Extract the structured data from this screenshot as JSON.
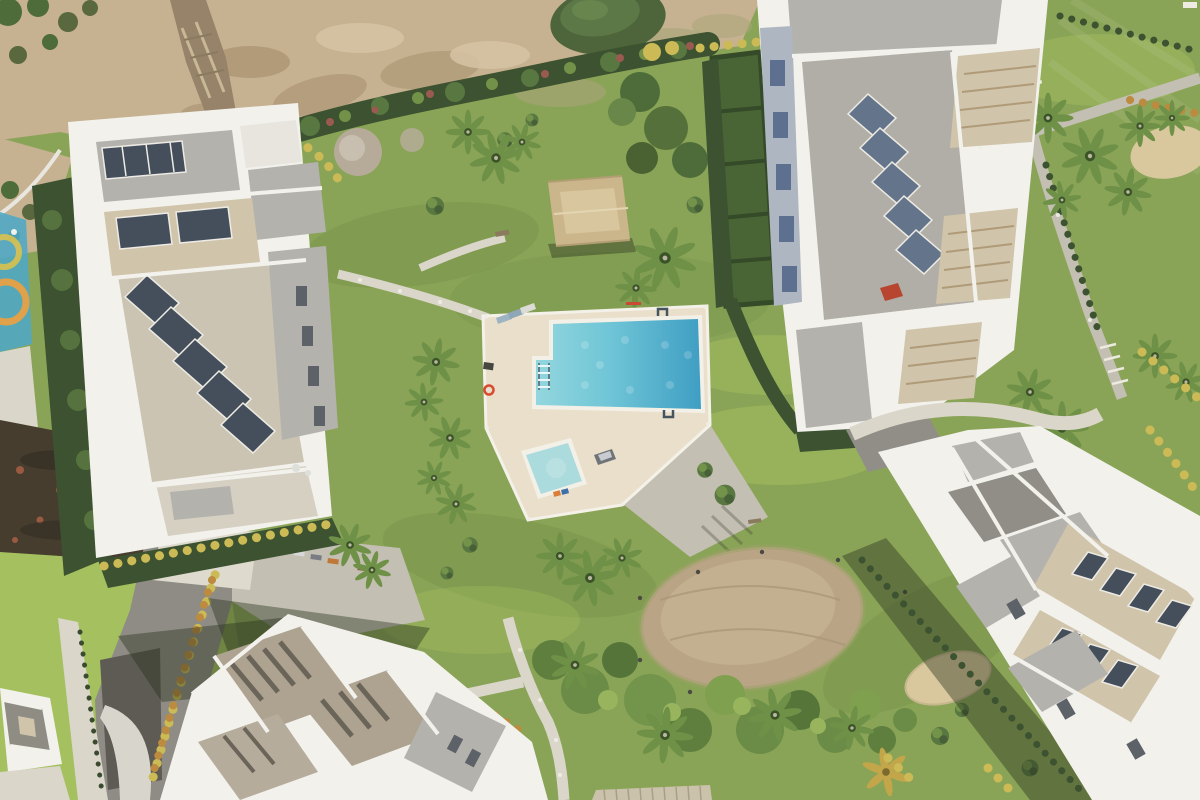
{
  "meta": {
    "title": "Aerial drone view of a modern white apartment complex with communal swimming pool, lawns, palm trees and garden paths",
    "view": "top-down aerial photograph",
    "time_of_day": "sunny daytime, shadows cast toward upper-left"
  },
  "palette": {
    "lawnBase": "#8AA457",
    "lawnLight": "#A4C05F",
    "lawnDark": "#6D8A45",
    "lawnShade": "#4F6A38",
    "dirtField": "#C6B191",
    "dirtDark": "#A8916F",
    "dirtLight": "#D7C6A6",
    "trench": "#96836A",
    "soilDark": "#463D2F",
    "hedgeDark": "#3C5230",
    "hedgeMid": "#597741",
    "hedgeLight": "#7C9C4E",
    "hedgeYellow": "#CBBA55",
    "hedgeOrange": "#BC8B3F",
    "treeGreen": "#4E6C39",
    "palmFrond": "#6E9147",
    "palmCore": "#3C5328",
    "palmGold": "#C2A649",
    "pathGray": "#C3BFB2",
    "pathLight": "#DAD6CA",
    "asphalt": "#5D5B54",
    "deckCream": "#EADFCB",
    "poolRim": "#F3F0E7",
    "poolPale": "#ACDBDE",
    "poolAqua": "#6FC5D6",
    "poolDeep": "#3F9EC3",
    "poolShallow": "#93D6DE",
    "bldWhite": "#F2F1EC",
    "roofGray": "#B4B2AC",
    "roofDark": "#908E87",
    "roofBrown": "#AEA391",
    "bldBeige": "#D0C4AB",
    "solarDark": "#454F5C",
    "solarBlue": "#64748A",
    "slotDark": "#5C6268",
    "shadow": "rgba(40,50,32,0.42)",
    "sand": "#D9C89E",
    "playBlue": "#4FA9C6",
    "playOrange": "#DFA14A",
    "carRed": "#B8452F"
  },
  "scene": {
    "landmarks": [
      {
        "name": "apartment-building-top-left",
        "desc": "White multi-storey block, rooftop terraces, diagonal rows of solar panels"
      },
      {
        "name": "apartment-building-top-right",
        "desc": "White block with large grey roof, solar panels and beige pergolas"
      },
      {
        "name": "apartment-building-bottom-right",
        "desc": "Angled white block with beige roof bands of solar panels"
      },
      {
        "name": "apartment-building-bottom-left",
        "desc": "White block with brown-grey roofs and skylight strips, long shadow"
      },
      {
        "name": "corner-house-bottom-left",
        "desc": "Small white house with grey roof at bottom-left corner"
      },
      {
        "name": "main-swimming-pool",
        "desc": "L-shaped turquoise pool with white coping, ladder and handrails"
      },
      {
        "name": "children-pool",
        "desc": "Small pale-aqua square pool on the same deck"
      },
      {
        "name": "pool-deck",
        "desc": "Cream travertine sun deck with loungers"
      },
      {
        "name": "pool-house",
        "desc": "Small tan hip-roofed pavilion north of the pool"
      },
      {
        "name": "bare-dirt-field",
        "desc": "Unlandscaped earth strip along the top with a construction trench"
      },
      {
        "name": "round-shrub-mound",
        "desc": "Dark green clipped mound at top centre"
      },
      {
        "name": "worn-grass-oval",
        "desc": "Large dry brown oval patch in the lawn, lower centre"
      },
      {
        "name": "tropical-planting-band",
        "desc": "Dense band of palms and shrubs across the bottom"
      },
      {
        "name": "flowering-hedge-band",
        "desc": "Long hedge with pink blooms separating dirt field from gardens"
      },
      {
        "name": "playground",
        "desc": "Small blue and orange playground at the left edge"
      },
      {
        "name": "parking-area",
        "desc": "Grey parking/driveway with a few cars, left of bottom building"
      },
      {
        "name": "garden-paths",
        "desc": "Light grey concrete paths with small bollard lights"
      },
      {
        "name": "boardwalk",
        "desc": "Timber boardwalk at the bottom edge"
      },
      {
        "name": "sand-patches",
        "desc": "Sandy play patches right side and top right"
      },
      {
        "name": "sun-loungers",
        "desc": "Loungers at top-left corner of the pool deck"
      },
      {
        "name": "lifebuoy",
        "desc": "Red-orange life ring on deck edge"
      },
      {
        "name": "golf-cart",
        "desc": "Small utility cart parked beside the deck"
      },
      {
        "name": "red-car",
        "desc": "Red car at the foot of the top-right building"
      },
      {
        "name": "private-gardens",
        "desc": "Hedged private garden plots beside top-right building"
      }
    ]
  }
}
